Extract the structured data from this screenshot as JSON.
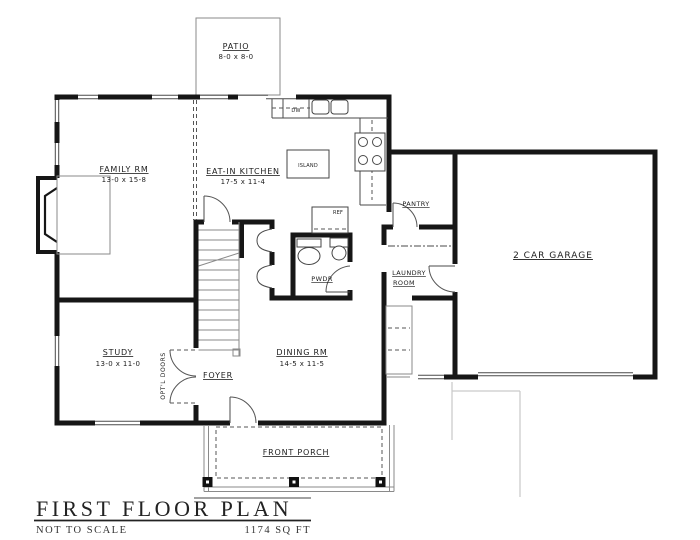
{
  "title_block": {
    "title": "FIRST FLOOR PLAN",
    "scale_note": "NOT TO SCALE",
    "area": "1174 SQ FT"
  },
  "rooms": {
    "patio": {
      "label": "PATIO",
      "dims": "8-0 x 8-0"
    },
    "family_room": {
      "label": "FAMILY RM",
      "dims": "13-0 x 15-8"
    },
    "kitchen": {
      "label": "EAT-IN KITCHEN",
      "dims": "17-5 x 11-4"
    },
    "island": {
      "label": "ISLAND"
    },
    "pantry": {
      "label": "PANTRY"
    },
    "garage": {
      "label": "2 CAR GARAGE"
    },
    "laundry": {
      "line1": "LAUNDRY",
      "line2": "ROOM"
    },
    "powder_room": {
      "label": "PWDR"
    },
    "study": {
      "label": "STUDY",
      "dims": "13-0 x 11-0"
    },
    "foyer": {
      "label": "FOYER"
    },
    "dining_room": {
      "label": "DINING RM",
      "dims": "14-5 x 11-5"
    },
    "front_porch": {
      "label": "FRONT PORCH"
    }
  },
  "annotations": {
    "optional_doors": "OPT'L DOORS",
    "refrigerator": "REF",
    "dishwasher": "DW"
  }
}
